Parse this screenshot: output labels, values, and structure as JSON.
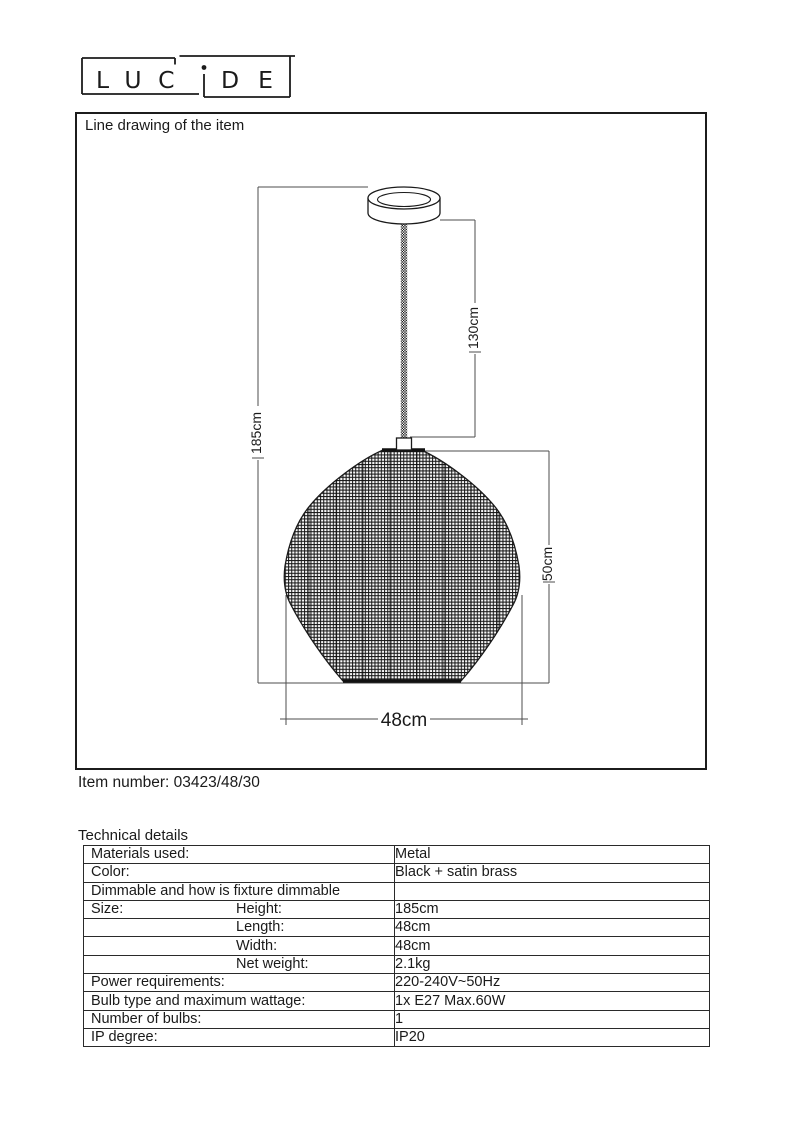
{
  "brand": {
    "name": "LUCIDE",
    "wordmark_left": "LUC",
    "wordmark_i": "i",
    "wordmark_right": "DE"
  },
  "drawing": {
    "box_title": "Line drawing of the item",
    "labels": {
      "overall_height": "185cm",
      "cord_height": "130cm",
      "shade_height": "50cm",
      "shade_width": "48cm"
    }
  },
  "item_number": "Item number: 03423/48/30",
  "technical": {
    "heading": "Technical details",
    "rows": [
      {
        "label": "Materials used:",
        "sub": "",
        "value": "Metal"
      },
      {
        "label": "Color:",
        "sub": "",
        "value": "Black + satin brass"
      },
      {
        "label": "Dimmable and how is fixture dimmable",
        "sub": "",
        "value": ""
      },
      {
        "label": "Size:",
        "sub": "Height:",
        "value": "185cm"
      },
      {
        "label": "",
        "sub": "Length:",
        "value": "48cm"
      },
      {
        "label": "",
        "sub": "Width:",
        "value": "48cm"
      },
      {
        "label": "",
        "sub": "Net weight:",
        "value": "2.1kg"
      },
      {
        "label": "Power requirements:",
        "sub": "",
        "value": "220-240V~50Hz"
      },
      {
        "label": "Bulb type and maximum wattage:",
        "sub": "",
        "value": "1x E27 Max.60W"
      },
      {
        "label": "Number of bulbs:",
        "sub": "",
        "value": "1"
      },
      {
        "label": "IP degree:",
        "sub": "",
        "value": "IP20"
      }
    ]
  }
}
